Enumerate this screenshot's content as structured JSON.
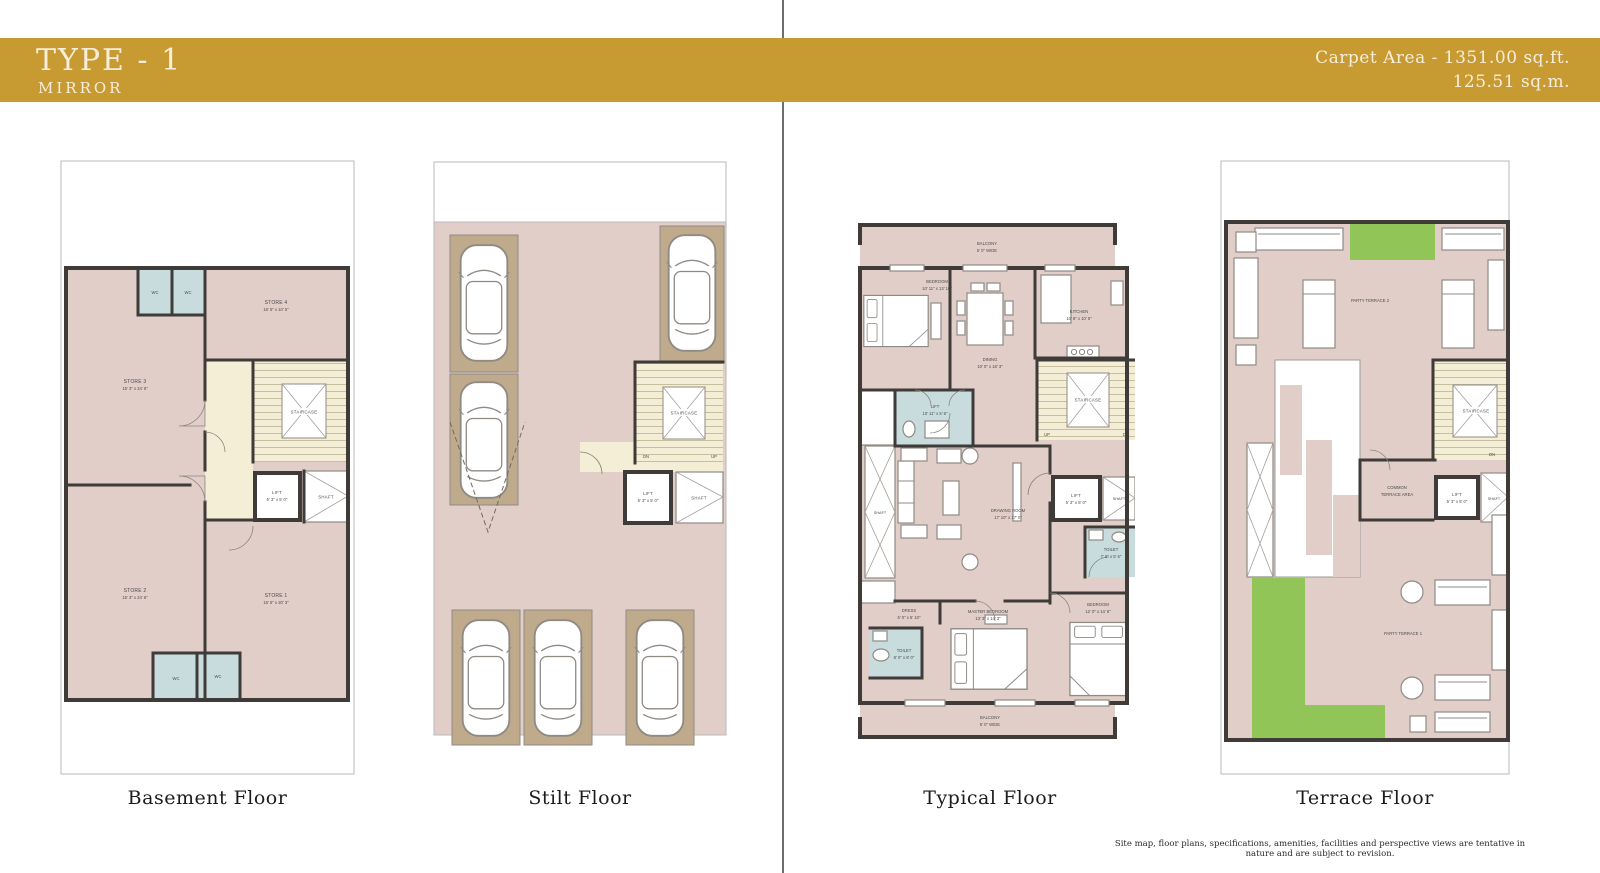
{
  "header": {
    "title": "TYPE - 1",
    "subtitle": "MIRROR",
    "carpet_line1": "Carpet Area - 1351.00 sq.ft.",
    "carpet_line2": "125.51 sq.m."
  },
  "captions": {
    "basement": "Basement Floor",
    "stilt": "Stilt Floor",
    "typical": "Typical Floor",
    "terrace": "Terrace Floor"
  },
  "disclaimer": "Site map, floor plans, specifications, amenities, facilities and perspective views are tentative in nature and are subject to revision.",
  "colors": {
    "accent_gold": "#C89A32",
    "plan_pink": "#E1CEC9",
    "stair_cream": "#F5EED6",
    "wet_area_blue": "#C8DCDD",
    "parking_tan": "#BFAB8B",
    "lawn_green": "#92C558",
    "wall_dark": "#3E3B38"
  },
  "basement": {
    "store3_name": "STORE 3",
    "store3_dim": "15' 3\" x 24' 9\"",
    "store4_name": "STORE 4",
    "store4_dim": "16' 6\" x 10' 5\"",
    "store2_name": "STORE 2",
    "store2_dim": "15' 3\" x 24' 6\"",
    "store1_name": "STORE 1",
    "store1_dim": "16' 6\" x 20' 3\"",
    "wc": "WC",
    "staircase": "STAIRCASE",
    "lift_name": "LIFT",
    "lift_dim": "5' 3\" x 5' 0\"",
    "shaft": "SHAFT"
  },
  "stilt": {
    "staircase": "STAIRCASE",
    "dn": "DN",
    "up": "UP",
    "lift_name": "LIFT",
    "lift_dim": "5' 3\" x 5' 0\"",
    "shaft": "SHAFT"
  },
  "typical": {
    "balcony_name": "BALCONY",
    "balcony_dim": "5' 0\" WIDE",
    "bedroom1_name": "BEDROOM",
    "bedroom1_dim": "10' 11\" x 13' 10\"",
    "dining_name": "DINING",
    "dining_dim": "10' 0\" x 18' 3\"",
    "kitchen_name": "KITCHEN",
    "kitchen_dim": "10' 8\" x 10' 5\"",
    "lift_top_name": "LIFT",
    "lift_top_dim": "10' 11\" x 5' 6\"",
    "shaft_left": "SHAFT",
    "drawing_name": "DRAWING ROOM",
    "drawing_dim": "17' 10\" x 17' 0\"",
    "staircase": "STAIRCASE",
    "up": "UP",
    "dn": "DN",
    "lift_name": "LIFT",
    "lift_dim": "5' 3\" x 5' 0\"",
    "shaft_right": "SHAFT",
    "toilet1_name": "TOILET",
    "toilet1_dim": "7' 6\" x 5' 6\"",
    "dress_name": "DRESS",
    "dress_dim": "6' 0\" x 5' 10\"",
    "master_name": "MASTER BEDROOM",
    "master_dim": "13' 3\" x 14' 3\"",
    "bedroom2_name": "BEDROOM",
    "bedroom2_dim": "12' 0\" x 14' 6\"",
    "toilet2_name": "TOILET",
    "toilet2_dim": "8' 0\" x 8' 0\""
  },
  "terrace": {
    "party2": "PARTY TERRACE 2",
    "party1": "PARTY TERRACE 1",
    "common1": "COMMON",
    "common2": "TERRACE AREA",
    "staircase": "STAIRCASE",
    "dn": "DN",
    "lift_name": "LIFT",
    "lift_dim": "5' 3\" x 5' 0\"",
    "shaft": "SHAFT"
  }
}
